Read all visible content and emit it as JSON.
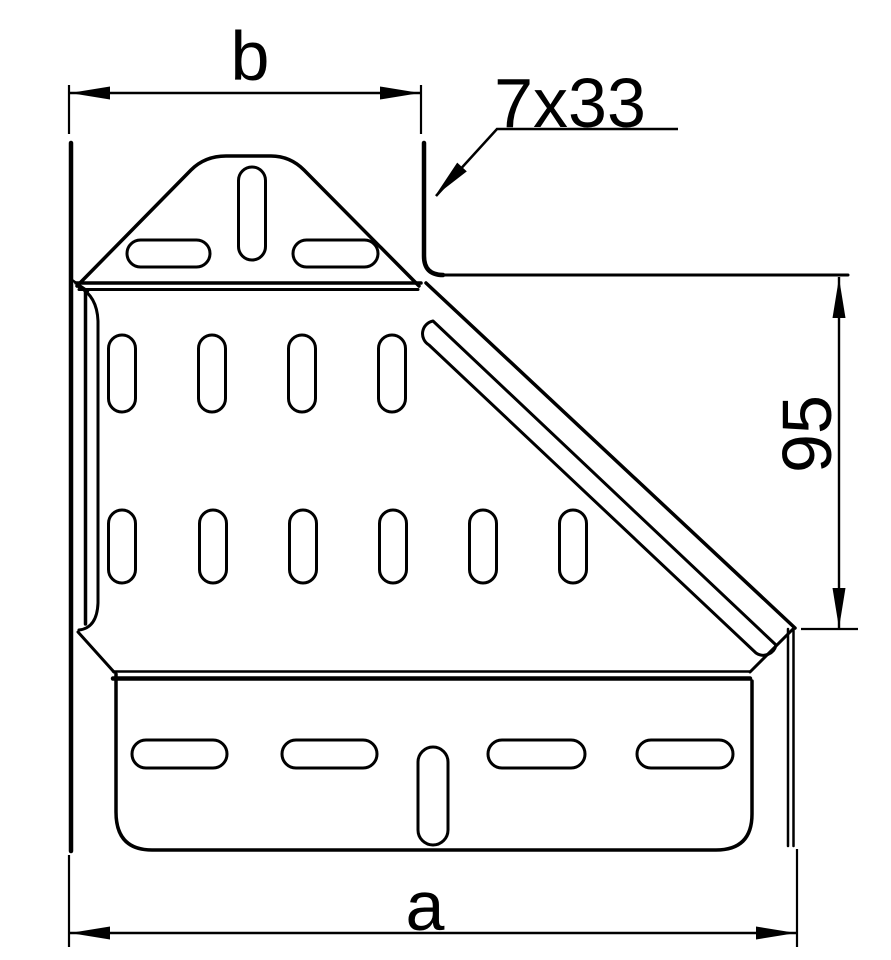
{
  "drawing": {
    "type": "technical-drawing",
    "background_color": "#ffffff",
    "line_color": "#000000",
    "labels": {
      "dim_top_width": "b",
      "dim_bottom_width": "a",
      "dim_right_height": "95",
      "slot_callout": "7x33"
    }
  }
}
